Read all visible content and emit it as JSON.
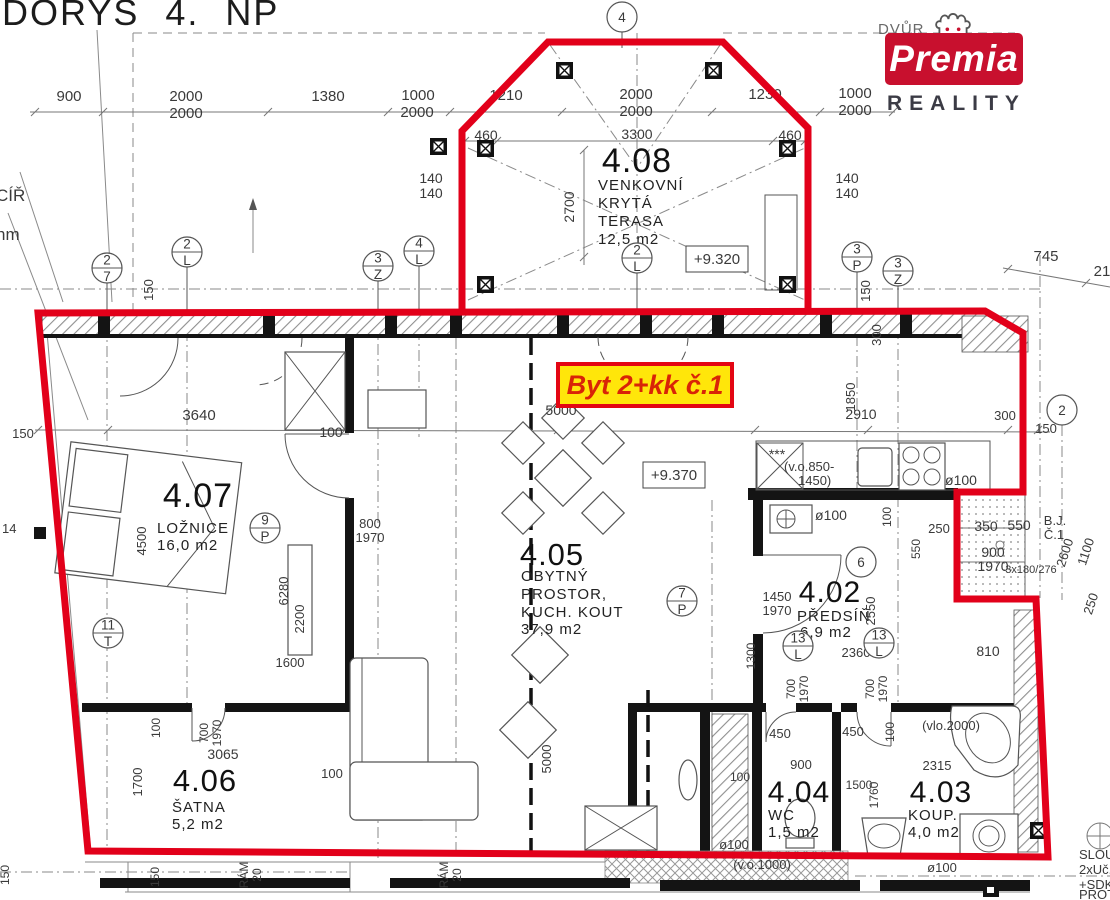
{
  "header": {
    "title": "DORYS 4. NP"
  },
  "logo": {
    "context_text": "DVŮR",
    "brand": "Premia",
    "subtitle": "REALITY",
    "brand_bg": "#c8102e"
  },
  "unit_label": {
    "text": "Byt 2+kk č.1",
    "bg": "#ffe60a",
    "border": "#e30613"
  },
  "rooms": {
    "terrace": {
      "num": "4.08",
      "line1": "VENKOVNÍ",
      "line2": "KRYTÁ",
      "line3": "TERASA",
      "area": "12,5  m2"
    },
    "bedroom": {
      "num": "4.07",
      "line1": "LOŽNICE",
      "area": "16,0  m2"
    },
    "living": {
      "num": "4.05",
      "line1": "OBYTNÝ",
      "line2": "PROSTOR,",
      "line3": "KUCH.  KOUT",
      "area": "37,9  m2"
    },
    "hall": {
      "num": "4.02",
      "line1": "PŘEDSÍŇ",
      "area": "6,9  m2"
    },
    "closet": {
      "num": "4.06",
      "line1": "ŠATNA",
      "area": "5,2  m2"
    },
    "wc": {
      "num": "4.04",
      "line1": "WC",
      "area": "1,5  m2"
    },
    "bath": {
      "num": "4.03",
      "line1": "KOUP.",
      "area": "4,0  m2"
    }
  },
  "levels": {
    "terrace_level": "+9.320",
    "living_level": "+9.370"
  },
  "colors": {
    "boundary_red": "#e2001a",
    "label_yellow": "#ffe60a"
  },
  "annotations": [
    {
      "t": "900",
      "x": 69,
      "y": 101,
      "s": 15
    },
    {
      "t": "2000",
      "x": 186,
      "y": 101,
      "s": 15
    },
    {
      "t": "2000",
      "x": 186,
      "y": 118,
      "s": 15
    },
    {
      "t": "1380",
      "x": 328,
      "y": 101,
      "s": 15
    },
    {
      "t": "1000",
      "x": 418,
      "y": 100,
      "s": 15
    },
    {
      "t": "2000",
      "x": 417,
      "y": 117,
      "s": 15
    },
    {
      "t": "1210",
      "x": 506,
      "y": 100,
      "s": 15
    },
    {
      "t": "2000",
      "x": 636,
      "y": 99,
      "s": 15
    },
    {
      "t": "2000",
      "x": 636,
      "y": 116,
      "s": 15
    },
    {
      "t": "1230",
      "x": 765,
      "y": 99,
      "s": 15
    },
    {
      "t": "1000",
      "x": 855,
      "y": 98,
      "s": 15
    },
    {
      "t": "2000",
      "x": 855,
      "y": 115,
      "s": 15
    },
    {
      "t": "460",
      "x": 486,
      "y": 140,
      "s": 14
    },
    {
      "t": "3300",
      "x": 637,
      "y": 139,
      "s": 14
    },
    {
      "t": "460",
      "x": 790,
      "y": 140,
      "s": 14
    },
    {
      "t": "140",
      "x": 431,
      "y": 183,
      "s": 14
    },
    {
      "t": "140",
      "x": 431,
      "y": 198,
      "s": 14
    },
    {
      "t": "140",
      "x": 847,
      "y": 183,
      "s": 14
    },
    {
      "t": "140",
      "x": 847,
      "y": 198,
      "s": 14
    },
    {
      "t": "2700",
      "x": 574,
      "y": 207,
      "s": 14,
      "r": -90
    },
    {
      "t": "745",
      "x": 1046,
      "y": 261,
      "s": 15
    },
    {
      "t": "21",
      "x": 1102,
      "y": 276,
      "s": 15
    },
    {
      "t": "150",
      "x": 153,
      "y": 290,
      "s": 13,
      "r": -90
    },
    {
      "t": "150",
      "x": 870,
      "y": 291,
      "s": 13,
      "r": -90
    },
    {
      "t": "300",
      "x": 881,
      "y": 335,
      "s": 13,
      "r": -90
    },
    {
      "t": "CÍŘ",
      "x": -4,
      "y": 201,
      "s": 17,
      "a": "start"
    },
    {
      "t": "hm",
      "x": -4,
      "y": 240,
      "s": 17,
      "a": "start"
    },
    {
      "t": "150",
      "x": 23,
      "y": 438,
      "s": 13
    },
    {
      "t": "3640",
      "x": 199,
      "y": 420,
      "s": 15
    },
    {
      "t": "100",
      "x": 331,
      "y": 437,
      "s": 14
    },
    {
      "t": "5000",
      "x": 561,
      "y": 415,
      "s": 14
    },
    {
      "t": "1850",
      "x": 855,
      "y": 397,
      "s": 13,
      "r": -90
    },
    {
      "t": "2910",
      "x": 861,
      "y": 419,
      "s": 14
    },
    {
      "t": "300",
      "x": 1005,
      "y": 420,
      "s": 13
    },
    {
      "t": "150",
      "x": 1046,
      "y": 433,
      "s": 13
    },
    {
      "t": "14",
      "x": 2,
      "y": 533,
      "s": 13,
      "a": "start"
    },
    {
      "t": "4500",
      "x": 146,
      "y": 541,
      "s": 13,
      "r": -90
    },
    {
      "t": "800",
      "x": 370,
      "y": 528,
      "s": 13
    },
    {
      "t": "1970",
      "x": 370,
      "y": 542,
      "s": 13
    },
    {
      "t": "6280",
      "x": 288,
      "y": 591,
      "s": 13,
      "r": -90
    },
    {
      "t": "2200",
      "x": 304,
      "y": 619,
      "s": 13,
      "r": -90
    },
    {
      "t": "1600",
      "x": 290,
      "y": 667,
      "s": 13
    },
    {
      "t": "***",
      "x": 777,
      "y": 459,
      "s": 14
    },
    {
      "t": "(v.o.850-",
      "x": 784,
      "y": 471,
      "s": 13,
      "a": "start"
    },
    {
      "t": "1450)",
      "x": 798,
      "y": 485,
      "s": 13,
      "a": "start"
    },
    {
      "t": "ø100",
      "x": 961,
      "y": 485,
      "s": 14
    },
    {
      "t": "ø100",
      "x": 831,
      "y": 520,
      "s": 14
    },
    {
      "t": "100",
      "x": 891,
      "y": 517,
      "s": 12,
      "r": -90
    },
    {
      "t": "550",
      "x": 920,
      "y": 549,
      "s": 12,
      "r": -90
    },
    {
      "t": "250",
      "x": 939,
      "y": 533,
      "s": 13
    },
    {
      "t": "350",
      "x": 986,
      "y": 531,
      "s": 14
    },
    {
      "t": "550",
      "x": 1019,
      "y": 530,
      "s": 14
    },
    {
      "t": "900",
      "x": 993,
      "y": 557,
      "s": 14
    },
    {
      "t": "1970",
      "x": 993,
      "y": 571,
      "s": 14
    },
    {
      "t": "3x180/276",
      "x": 1031,
      "y": 573,
      "s": 11
    },
    {
      "t": "B.J.",
      "x": 1055,
      "y": 525,
      "s": 13
    },
    {
      "t": "Č.1",
      "x": 1054,
      "y": 539,
      "s": 13
    },
    {
      "t": "2600",
      "x": 1069,
      "y": 554,
      "s": 13,
      "r": -72
    },
    {
      "t": "1100",
      "x": 1090,
      "y": 553,
      "s": 13,
      "r": -72
    },
    {
      "t": "250",
      "x": 1095,
      "y": 605,
      "s": 13,
      "r": -72
    },
    {
      "t": "810",
      "x": 988,
      "y": 656,
      "s": 14
    },
    {
      "t": "1450",
      "x": 777,
      "y": 601,
      "s": 13
    },
    {
      "t": "1970",
      "x": 777,
      "y": 615,
      "s": 13
    },
    {
      "t": "2550",
      "x": 875,
      "y": 611,
      "s": 13,
      "r": -90
    },
    {
      "t": "2360",
      "x": 856,
      "y": 657,
      "s": 13
    },
    {
      "t": "1300",
      "x": 755,
      "y": 656,
      "s": 12,
      "r": -90
    },
    {
      "t": "700",
      "x": 795,
      "y": 689,
      "s": 12,
      "r": -90
    },
    {
      "t": "1970",
      "x": 808,
      "y": 689,
      "s": 12,
      "r": -90
    },
    {
      "t": "700",
      "x": 874,
      "y": 689,
      "s": 12,
      "r": -90
    },
    {
      "t": "1970",
      "x": 887,
      "y": 689,
      "s": 12,
      "r": -90
    },
    {
      "t": "100",
      "x": 160,
      "y": 728,
      "s": 12,
      "r": -90
    },
    {
      "t": "700",
      "x": 208,
      "y": 733,
      "s": 12,
      "r": -90
    },
    {
      "t": "1970",
      "x": 221,
      "y": 733,
      "s": 12,
      "r": -90
    },
    {
      "t": "3065",
      "x": 223,
      "y": 759,
      "s": 14
    },
    {
      "t": "1700",
      "x": 142,
      "y": 782,
      "s": 13,
      "r": -90
    },
    {
      "t": "100",
      "x": 332,
      "y": 778,
      "s": 13
    },
    {
      "t": "100",
      "x": 740,
      "y": 781,
      "s": 12
    },
    {
      "t": "450",
      "x": 780,
      "y": 738,
      "s": 13
    },
    {
      "t": "900",
      "x": 801,
      "y": 769,
      "s": 13
    },
    {
      "t": "450",
      "x": 853,
      "y": 736,
      "s": 13
    },
    {
      "t": "100",
      "x": 894,
      "y": 732,
      "s": 12,
      "r": -90
    },
    {
      "t": "(vlo.2000)",
      "x": 951,
      "y": 730,
      "s": 13
    },
    {
      "t": "2315",
      "x": 937,
      "y": 770,
      "s": 13
    },
    {
      "t": "1500",
      "x": 859,
      "y": 789,
      "s": 12
    },
    {
      "t": "1760",
      "x": 878,
      "y": 795,
      "s": 12,
      "r": -90
    },
    {
      "t": "ø100",
      "x": 734,
      "y": 849,
      "s": 13
    },
    {
      "t": "(v.o.1000)",
      "x": 762,
      "y": 869,
      "s": 13
    },
    {
      "t": "ø100",
      "x": 942,
      "y": 872,
      "s": 13
    },
    {
      "t": "150",
      "x": 9,
      "y": 875,
      "s": 12,
      "r": -90
    },
    {
      "t": "150",
      "x": 159,
      "y": 877,
      "s": 12,
      "r": -90
    },
    {
      "t": "RÁM",
      "x": 248,
      "y": 875,
      "s": 12,
      "r": -90
    },
    {
      "t": "20",
      "x": 261,
      "y": 875,
      "s": 12,
      "r": -90
    },
    {
      "t": "RÁM",
      "x": 448,
      "y": 875,
      "s": 12,
      "r": -90
    },
    {
      "t": "20",
      "x": 461,
      "y": 875,
      "s": 12,
      "r": -90
    },
    {
      "t": "5000",
      "x": 551,
      "y": 759,
      "s": 13,
      "r": -90
    },
    {
      "t": "SLOUP",
      "x": 1079,
      "y": 859,
      "s": 13,
      "a": "start"
    },
    {
      "t": "2xUč.",
      "x": 1079,
      "y": 874,
      "s": 13,
      "a": "start"
    },
    {
      "t": "+SDK",
      "x": 1079,
      "y": 889,
      "s": 13,
      "a": "start"
    },
    {
      "t": "PROTI",
      "x": 1079,
      "y": 899,
      "s": 13,
      "a": "start"
    }
  ],
  "grid_markers": [
    {
      "x": 107,
      "y": 268,
      "top": "2",
      "bot": "7",
      "stem": 27
    },
    {
      "x": 187,
      "y": 252,
      "top": "2",
      "bot": "L",
      "stem": 43
    },
    {
      "x": 378,
      "y": 266,
      "top": "3",
      "bot": "Z",
      "stem": 29
    },
    {
      "x": 419,
      "y": 251,
      "top": "4",
      "bot": "L",
      "stem": 44
    },
    {
      "x": 637,
      "y": 258,
      "top": "2",
      "bot": "L",
      "stem": 37
    },
    {
      "x": 857,
      "y": 257,
      "top": "3",
      "bot": "P",
      "stem": 38
    },
    {
      "x": 898,
      "y": 271,
      "top": "3",
      "bot": "Z",
      "stem": 24
    },
    {
      "x": 622,
      "y": 17,
      "top": "4",
      "bot": "",
      "stem": 16
    },
    {
      "x": 1062,
      "y": 410,
      "top": "2",
      "bot": "",
      "stem": 0
    },
    {
      "x": 265,
      "y": 528,
      "top": "9",
      "bot": "P",
      "stem": 0
    },
    {
      "x": 108,
      "y": 633,
      "top": "11",
      "bot": "T",
      "stem": 0
    },
    {
      "x": 682,
      "y": 601,
      "top": "7",
      "bot": "P",
      "stem": 0
    },
    {
      "x": 861,
      "y": 562,
      "top": "6",
      "bot": "",
      "stem": 0
    },
    {
      "x": 798,
      "y": 646,
      "top": "13",
      "bot": "L",
      "stem": 0
    },
    {
      "x": 879,
      "y": 643,
      "top": "13",
      "bot": "L",
      "stem": 0
    }
  ]
}
